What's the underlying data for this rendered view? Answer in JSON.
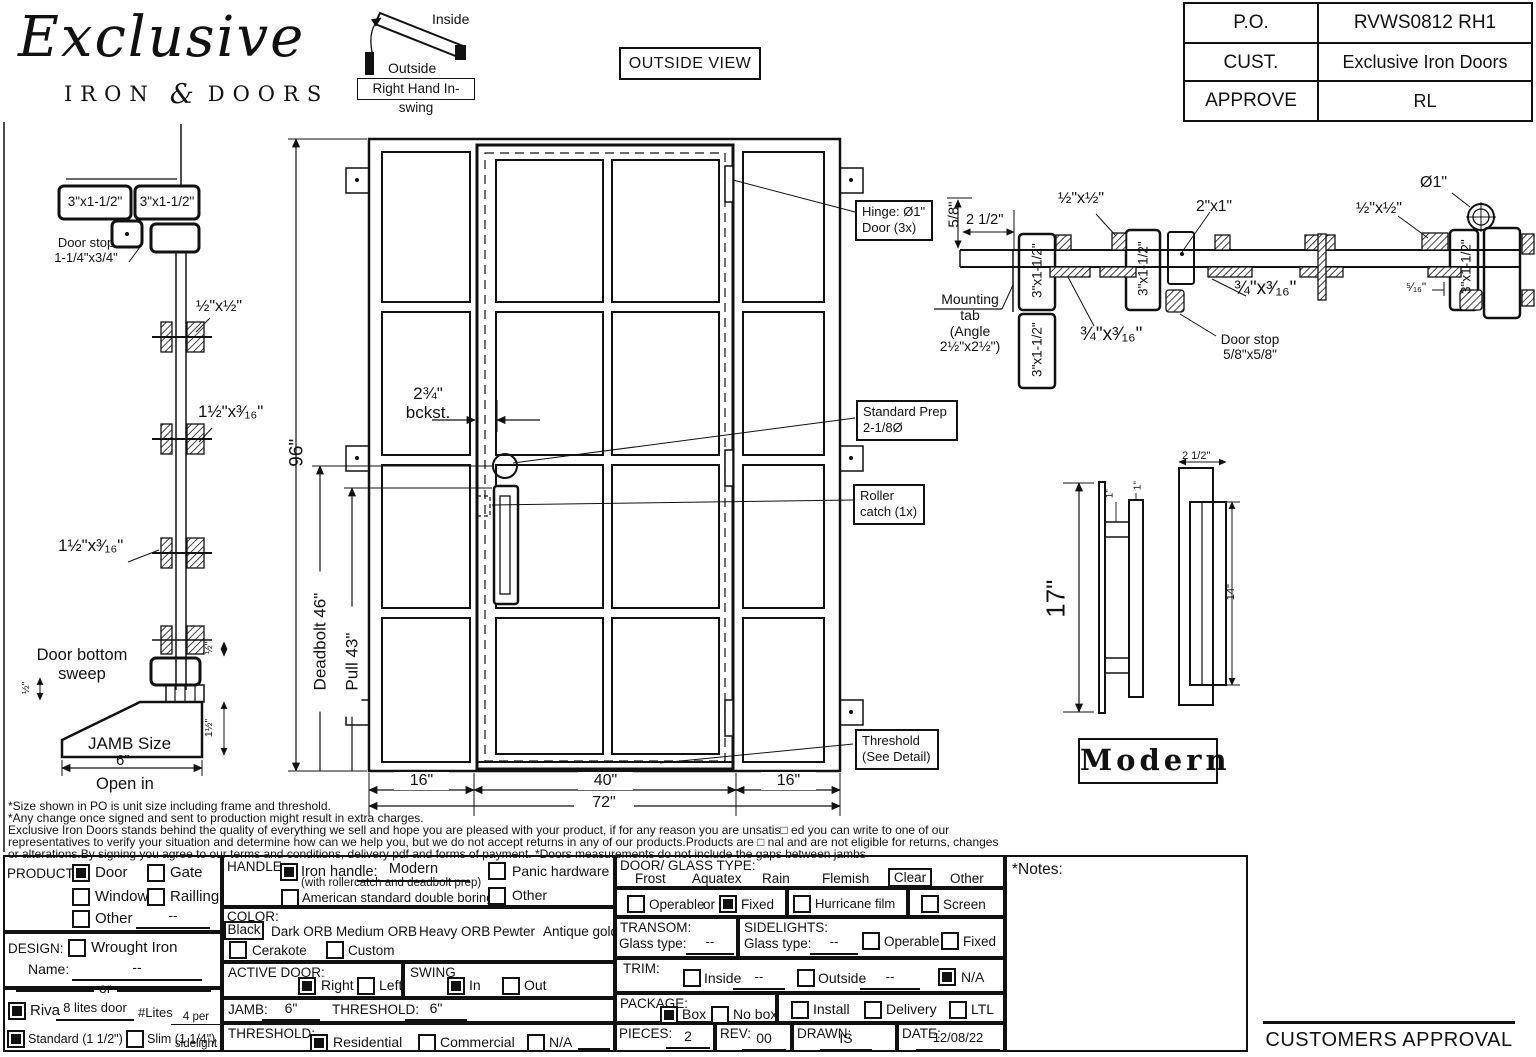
{
  "header": {
    "logo": {
      "title": "Exclusive",
      "sub_left": "IRON",
      "sub_amp": "&",
      "sub_right": "DOORS"
    },
    "swing": {
      "inside": "Inside",
      "outside": "Outside",
      "caption": "Right Hand In-swing"
    },
    "view_label": "OUTSIDE VIEW",
    "po_table": {
      "rows": [
        {
          "label": "P.O.",
          "value": "RVWS0812 RH1"
        },
        {
          "label": "CUST.",
          "value": "Exclusive Iron Doors"
        },
        {
          "label": "APPROVE",
          "value": "RL"
        }
      ]
    }
  },
  "jamb_detail": {
    "tube_left": "3\"x1-1/2\"",
    "tube_right": "3\"x1-1/2\"",
    "door_stop": "Door stop\n1-1/4\"x3/4\"",
    "clip_small": "½\"x½\"",
    "clip_mid": "1½\"x³⁄₁₆\"",
    "clip_low": "1½\"x³⁄₁₆\"",
    "sweep": "Door bottom\nsweep",
    "jamb_size": "JAMB Size",
    "jamb_width": "6”",
    "open_in": "Open in",
    "dim_half_left": "½\"",
    "dim_half_right": "½\"",
    "dim_one_half": "1½\""
  },
  "elevation": {
    "height": "96\"",
    "deadbolt": "Deadbolt 46\"",
    "pull": "Pull 43\"",
    "backset": "2¾\"\nbckst.",
    "hinge_note": "Hinge: Ø1\"\nDoor (3x)",
    "prep_note": "Standard Prep\n2-1/8Ø",
    "roller_note": "Roller\ncatch (1x)",
    "threshold_note": "Threshold\n(See Detail)",
    "w_left": "16\"",
    "w_mid": "40\"",
    "w_right": "16\"",
    "w_total": "72\""
  },
  "head_detail": {
    "dim_58": "5/8\"",
    "dim_212": "2 1/2\"",
    "mounting_tab": "Mounting\ntab\n(Angle\n2½\"x2½\")",
    "tube": "3\"x1-1/2\"",
    "clip_half_l": "½\"x½\"",
    "clip_half_r": "½\"x½\"",
    "clip_34_l": "¾\"x³⁄₁₆\"",
    "clip_34_r": "¾\"x³⁄₁₆\"",
    "tube_2x1": "2\"x1\"",
    "hinge_dia": "Ø1\"",
    "dim_516": "⁵⁄₁₆\"",
    "door_stop": "Door stop\n5/8\"x5/8\""
  },
  "handle_detail": {
    "height": "17\"",
    "dim1a": "1\"",
    "dim1b": "1\"",
    "width": "2 1/2\"",
    "inner": "14\"",
    "name": "Modern"
  },
  "disclaimer": {
    "lines": [
      "*Size shown in PO is unit size including frame and threshold.",
      "*Any change once signed and sent to production might result in extra charges.",
      "Exclusive Iron Doors stands behind the quality of everything we sell and hope you are pleased with your product, if for any reason you are unsatis□ ed you can write to one of our",
      "representatives to verify your situation and determine how can we help you, but we do not accept returns in any of our products.Products are □ nal and are not eligible for returns, changes",
      "or alterations.By signing you agree to our terms and conditions, delivery pdf and forms of payment. *Doors measurements do not include the gaps between jambs"
    ]
  },
  "form": {
    "product": {
      "label": "PRODUCT:",
      "door": "Door",
      "door_checked": true,
      "gate": "Gate",
      "window": "Window",
      "railing": "Railling",
      "other": "Other",
      "other_value": "--"
    },
    "design": {
      "label": "DESIGN:",
      "wrought": "Wrought Iron",
      "name_label": "Name:",
      "name_value": "--",
      "or_label": "or"
    },
    "series": {
      "riva": "Riva",
      "riva_checked": true,
      "riva_value": "8 lites door",
      "lites_label": "#Lites",
      "lites_top": "4 per",
      "lites_bottom": "sidelight",
      "standard": "Standard (1 1/2\")",
      "standard_checked": true,
      "slim": "Slim (1 1/4\")"
    },
    "handle": {
      "label": "HANDLE:",
      "iron": "Iron handle:",
      "iron_checked": true,
      "iron_value": "Modern",
      "iron_note": "(with rollercatch and deadbolt prep)",
      "american": "American standard double boring",
      "panic": "Panic hardware",
      "other": "Other"
    },
    "color": {
      "label": "COLOR:",
      "selected": "Black",
      "options": [
        "Dark ORB",
        "Medium ORB",
        "Heavy ORB",
        "Pewter",
        "Antique gold"
      ],
      "cerakote": "Cerakote",
      "custom": "Custom"
    },
    "active_door": {
      "label": "ACTIVE DOOR:",
      "right": "Right",
      "right_checked": true,
      "left": "Left"
    },
    "swing": {
      "label": "SWING",
      "in_label": "In",
      "in_checked": true,
      "out_label": "Out"
    },
    "jamb_row": {
      "jamb": "JAMB:",
      "jamb_value": "6\"",
      "threshold": "THRESHOLD:",
      "threshold_value": "6\""
    },
    "threshold": {
      "label": "THRESHOLD:",
      "residential": "Residential",
      "residential_checked": true,
      "commercial": "Commercial",
      "na": "N/A"
    },
    "glass": {
      "label": "DOOR/ GLASS TYPE:",
      "options": [
        "Frost",
        "Aquatex",
        "Rain",
        "Flemish"
      ],
      "selected": "Clear",
      "other": "Other",
      "operable": "Operable",
      "or_label": "or",
      "fixed": "Fixed",
      "fixed_checked": true,
      "hurricane": "Hurricane film",
      "screen": "Screen"
    },
    "transom": {
      "label": "TRANSOM:",
      "glass_label": "Glass type:",
      "value": "--"
    },
    "sidelights": {
      "label": "SIDELIGHTS:",
      "glass_label": "Glass type:",
      "value": "--",
      "operable": "Operable",
      "fixed": "Fixed"
    },
    "trim": {
      "label": "TRIM:",
      "inside": "Inside",
      "inside_value": "--",
      "outside": "Outside",
      "outside_value": "--",
      "na": "N/A",
      "na_checked": true
    },
    "package": {
      "label": "PACKAGE:",
      "box": "Box",
      "box_checked": true,
      "nobox": "No box",
      "install": "Install",
      "delivery": "Delivery",
      "ltl": "LTL"
    },
    "meta": {
      "pieces_label": "PIECES:",
      "pieces": "2",
      "rev_label": "REV:",
      "rev": "00",
      "drawn_label": "DRAWN:",
      "drawn": "IS",
      "date_label": "DATE:",
      "date": "12/08/22"
    },
    "notes_label": "*Notes:"
  },
  "approval": "CUSTOMERS APPROVAL"
}
